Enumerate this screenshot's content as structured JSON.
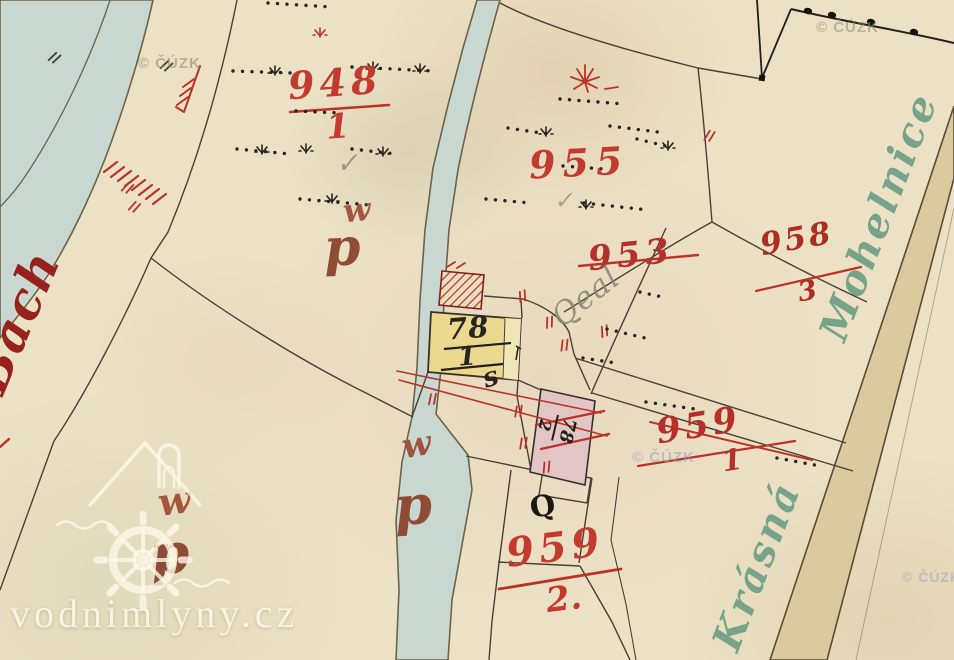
{
  "map": {
    "title": "Historical cadastral map scan",
    "region_label_left": "Bach",
    "region_label_right_1": "Krásná",
    "region_label_right_2": "Mohelnice"
  },
  "watermarks": {
    "cuzk": "© ČÚZK",
    "site": "vodnimlyny.cz"
  },
  "parcels": {
    "p948": {
      "numerator": "948",
      "denominator": "1"
    },
    "p955": {
      "number": "955"
    },
    "p958": {
      "numerator": "958",
      "denominator": "3"
    },
    "p953": {
      "number": "953",
      "struck_through": true
    },
    "p959_1": {
      "numerator": "959",
      "denominator": "1"
    },
    "p959_2": {
      "numerator": "959",
      "denominator": "2."
    }
  },
  "buildings": {
    "b78_1": {
      "numerator": "78",
      "denominator": "1",
      "fill": "#ead98f"
    },
    "b78_2": {
      "numerator": "78",
      "denominator": "2",
      "fill": "#e2c6c6"
    }
  },
  "annotations": {
    "land_use_w": "w",
    "land_use_p": "p",
    "stable_mark": "s",
    "well_mark": "Q",
    "pencil_word": "Qeal",
    "check_mark": "✓"
  },
  "palette": {
    "paper": "#ece1c5",
    "water": "#c8d7cf",
    "road": "#dcca9f",
    "red_ink": "#bb3328",
    "black_ink": "#2b251e",
    "green_script": "#76a389",
    "brown_letters": "#9c5340"
  }
}
